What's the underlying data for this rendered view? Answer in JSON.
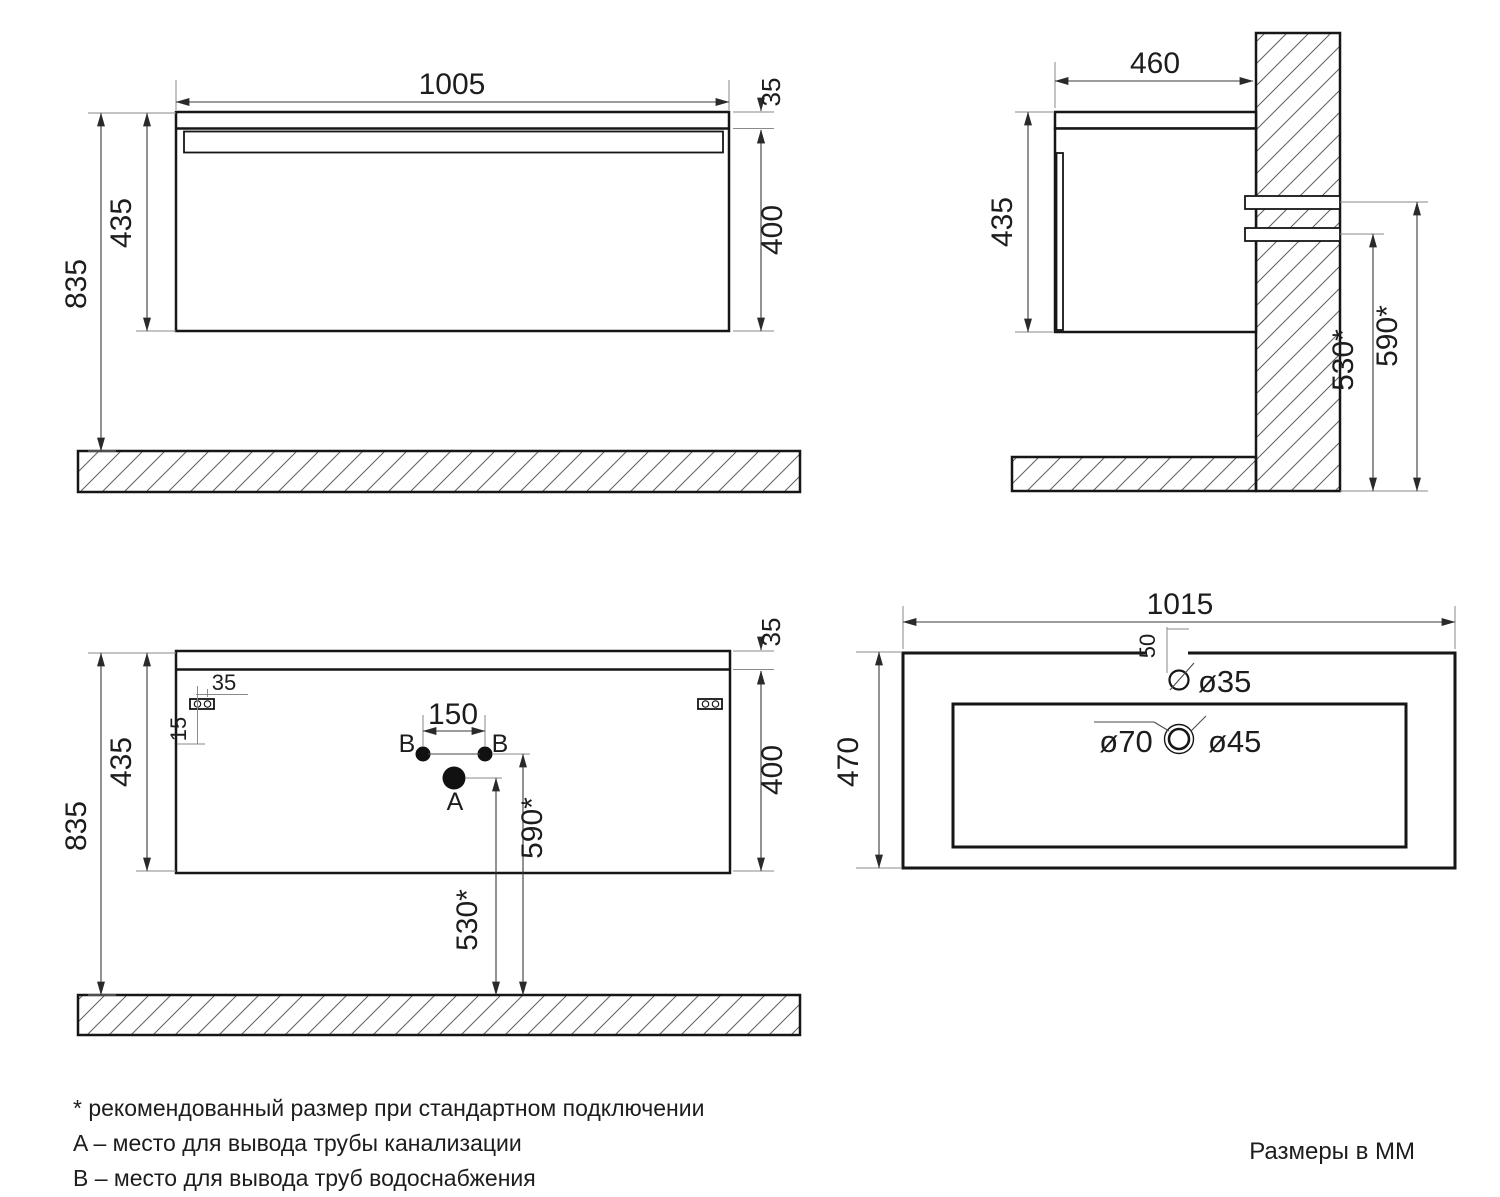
{
  "front_view": {
    "width": "1005",
    "floor_height": "835",
    "cabinet_height": "435",
    "top_thickness": "35",
    "front_panel_height": "400"
  },
  "side_view": {
    "depth": "460",
    "cabinet_height": "435",
    "drain_outlet_height": "530*",
    "water_outlet_height": "590*"
  },
  "back_view": {
    "floor_height": "835",
    "cabinet_height": "435",
    "top_thickness": "35",
    "front_panel_height": "400",
    "bracket_hole_spacing": "35",
    "bracket_offset": "15",
    "water_hole_spacing": "150",
    "water_outlet_height": "590*",
    "drain_outlet_height": "530*",
    "hole_a_label": "A",
    "hole_b_label": "B"
  },
  "top_view": {
    "width": "1015",
    "depth": "470",
    "faucet_offset": "50",
    "faucet_dia": "ø35",
    "drain_outer_dia": "ø70",
    "drain_inner_dia": "ø45"
  },
  "notes": [
    "* рекомендованный размер при стандартном подключении",
    "A – место для вывода трубы канализации",
    "B – место для вывода труб водоснабжения"
  ],
  "units_label": "Размеры в ММ"
}
